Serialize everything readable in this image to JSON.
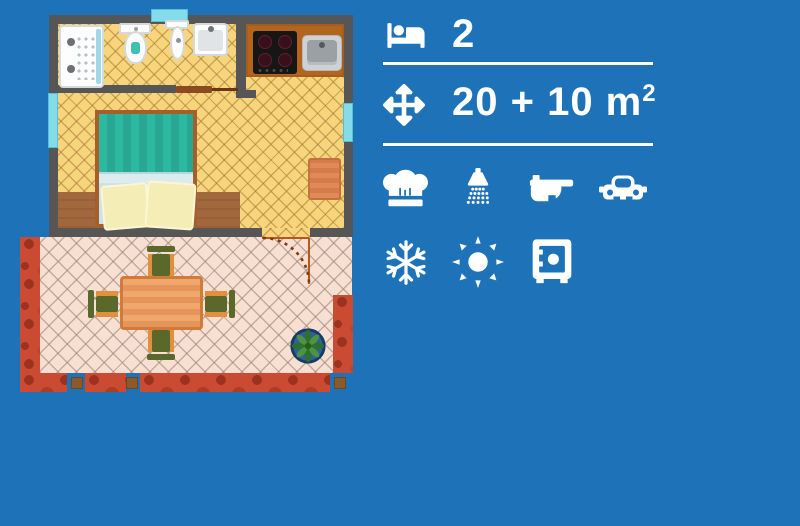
{
  "title": "apartment floor plan infographic",
  "colors": {
    "background": "#1e73b8",
    "icon_color": "#ffffff",
    "wall": "#565656",
    "indoor_floor": "#f6d57d",
    "wood_floor": "#a2673c",
    "terrace_floor": "#f7e0d1",
    "terrace_border": "#cb4a32",
    "window": "#84dbe9",
    "kitchen_counter": "#b3651f",
    "bed_blanket": "#2bb8a1",
    "table": "#e9995c",
    "chair": "#5a682c"
  },
  "info_panel": {
    "occupancy": {
      "icon": "bed-icon",
      "value": "2"
    },
    "area": {
      "icon": "move-arrows-icon",
      "value": "20 + 10 m",
      "sup": "2"
    },
    "amenities_row1": [
      {
        "icon": "chef-hat-icon",
        "name": "kitchen"
      },
      {
        "icon": "shower-icon",
        "name": "shower"
      },
      {
        "icon": "wc-icon",
        "name": "wc"
      },
      {
        "icon": "car-icon",
        "name": "parking"
      }
    ],
    "amenities_row2": [
      {
        "icon": "snowflake-icon",
        "name": "air-conditioning"
      },
      {
        "icon": "sun-icon",
        "name": "heating"
      },
      {
        "icon": "safe-icon",
        "name": "safe"
      }
    ]
  },
  "floor_plan": {
    "rooms": [
      "bathroom",
      "kitchen",
      "bedroom",
      "terrace"
    ],
    "fixtures": [
      "shower",
      "toilet",
      "bidet",
      "washbasin",
      "cooktop",
      "kitchen-sink",
      "double-bed",
      "rug",
      "dining-table",
      "four-chairs",
      "potted-plant",
      "door-swing",
      "three-windows"
    ]
  }
}
